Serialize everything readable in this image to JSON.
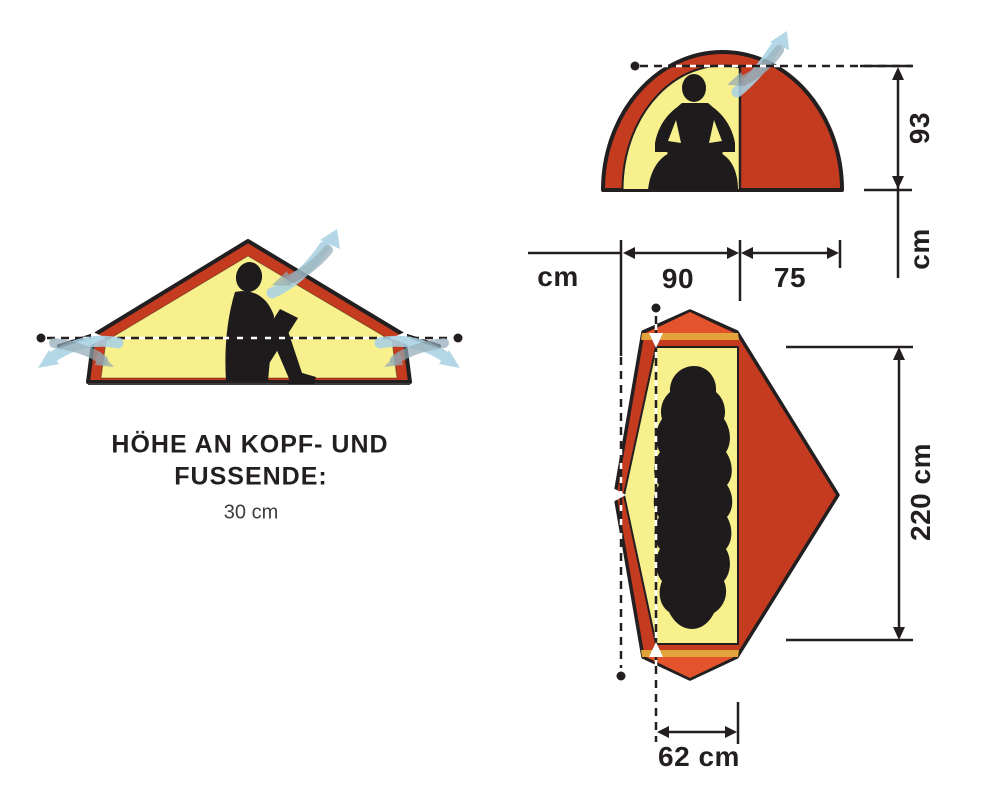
{
  "side_view": {
    "caption_line1": "HÖHE AN KOPF- UND",
    "caption_line2": "FUSSENDE:",
    "caption_value": "30 cm"
  },
  "front_view": {
    "width_unit_label": "cm",
    "inner_width_value": "90",
    "vestibule_width_value": "75",
    "inner_height_value": "93",
    "height_unit_label": "cm"
  },
  "top_view": {
    "length_value": "220 cm",
    "end_width_value": "62 cm"
  },
  "colors": {
    "tent_red": "#c43b20",
    "tent_orange": "#e4542c",
    "pole_gold": "#e3a33b",
    "tent_yellow": "#f7f08d",
    "silhouette_black": "#1d1b1b",
    "airflow_blue": "#a9d2e4",
    "airflow_gray": "#90aab6",
    "line_black": "#231f20"
  }
}
